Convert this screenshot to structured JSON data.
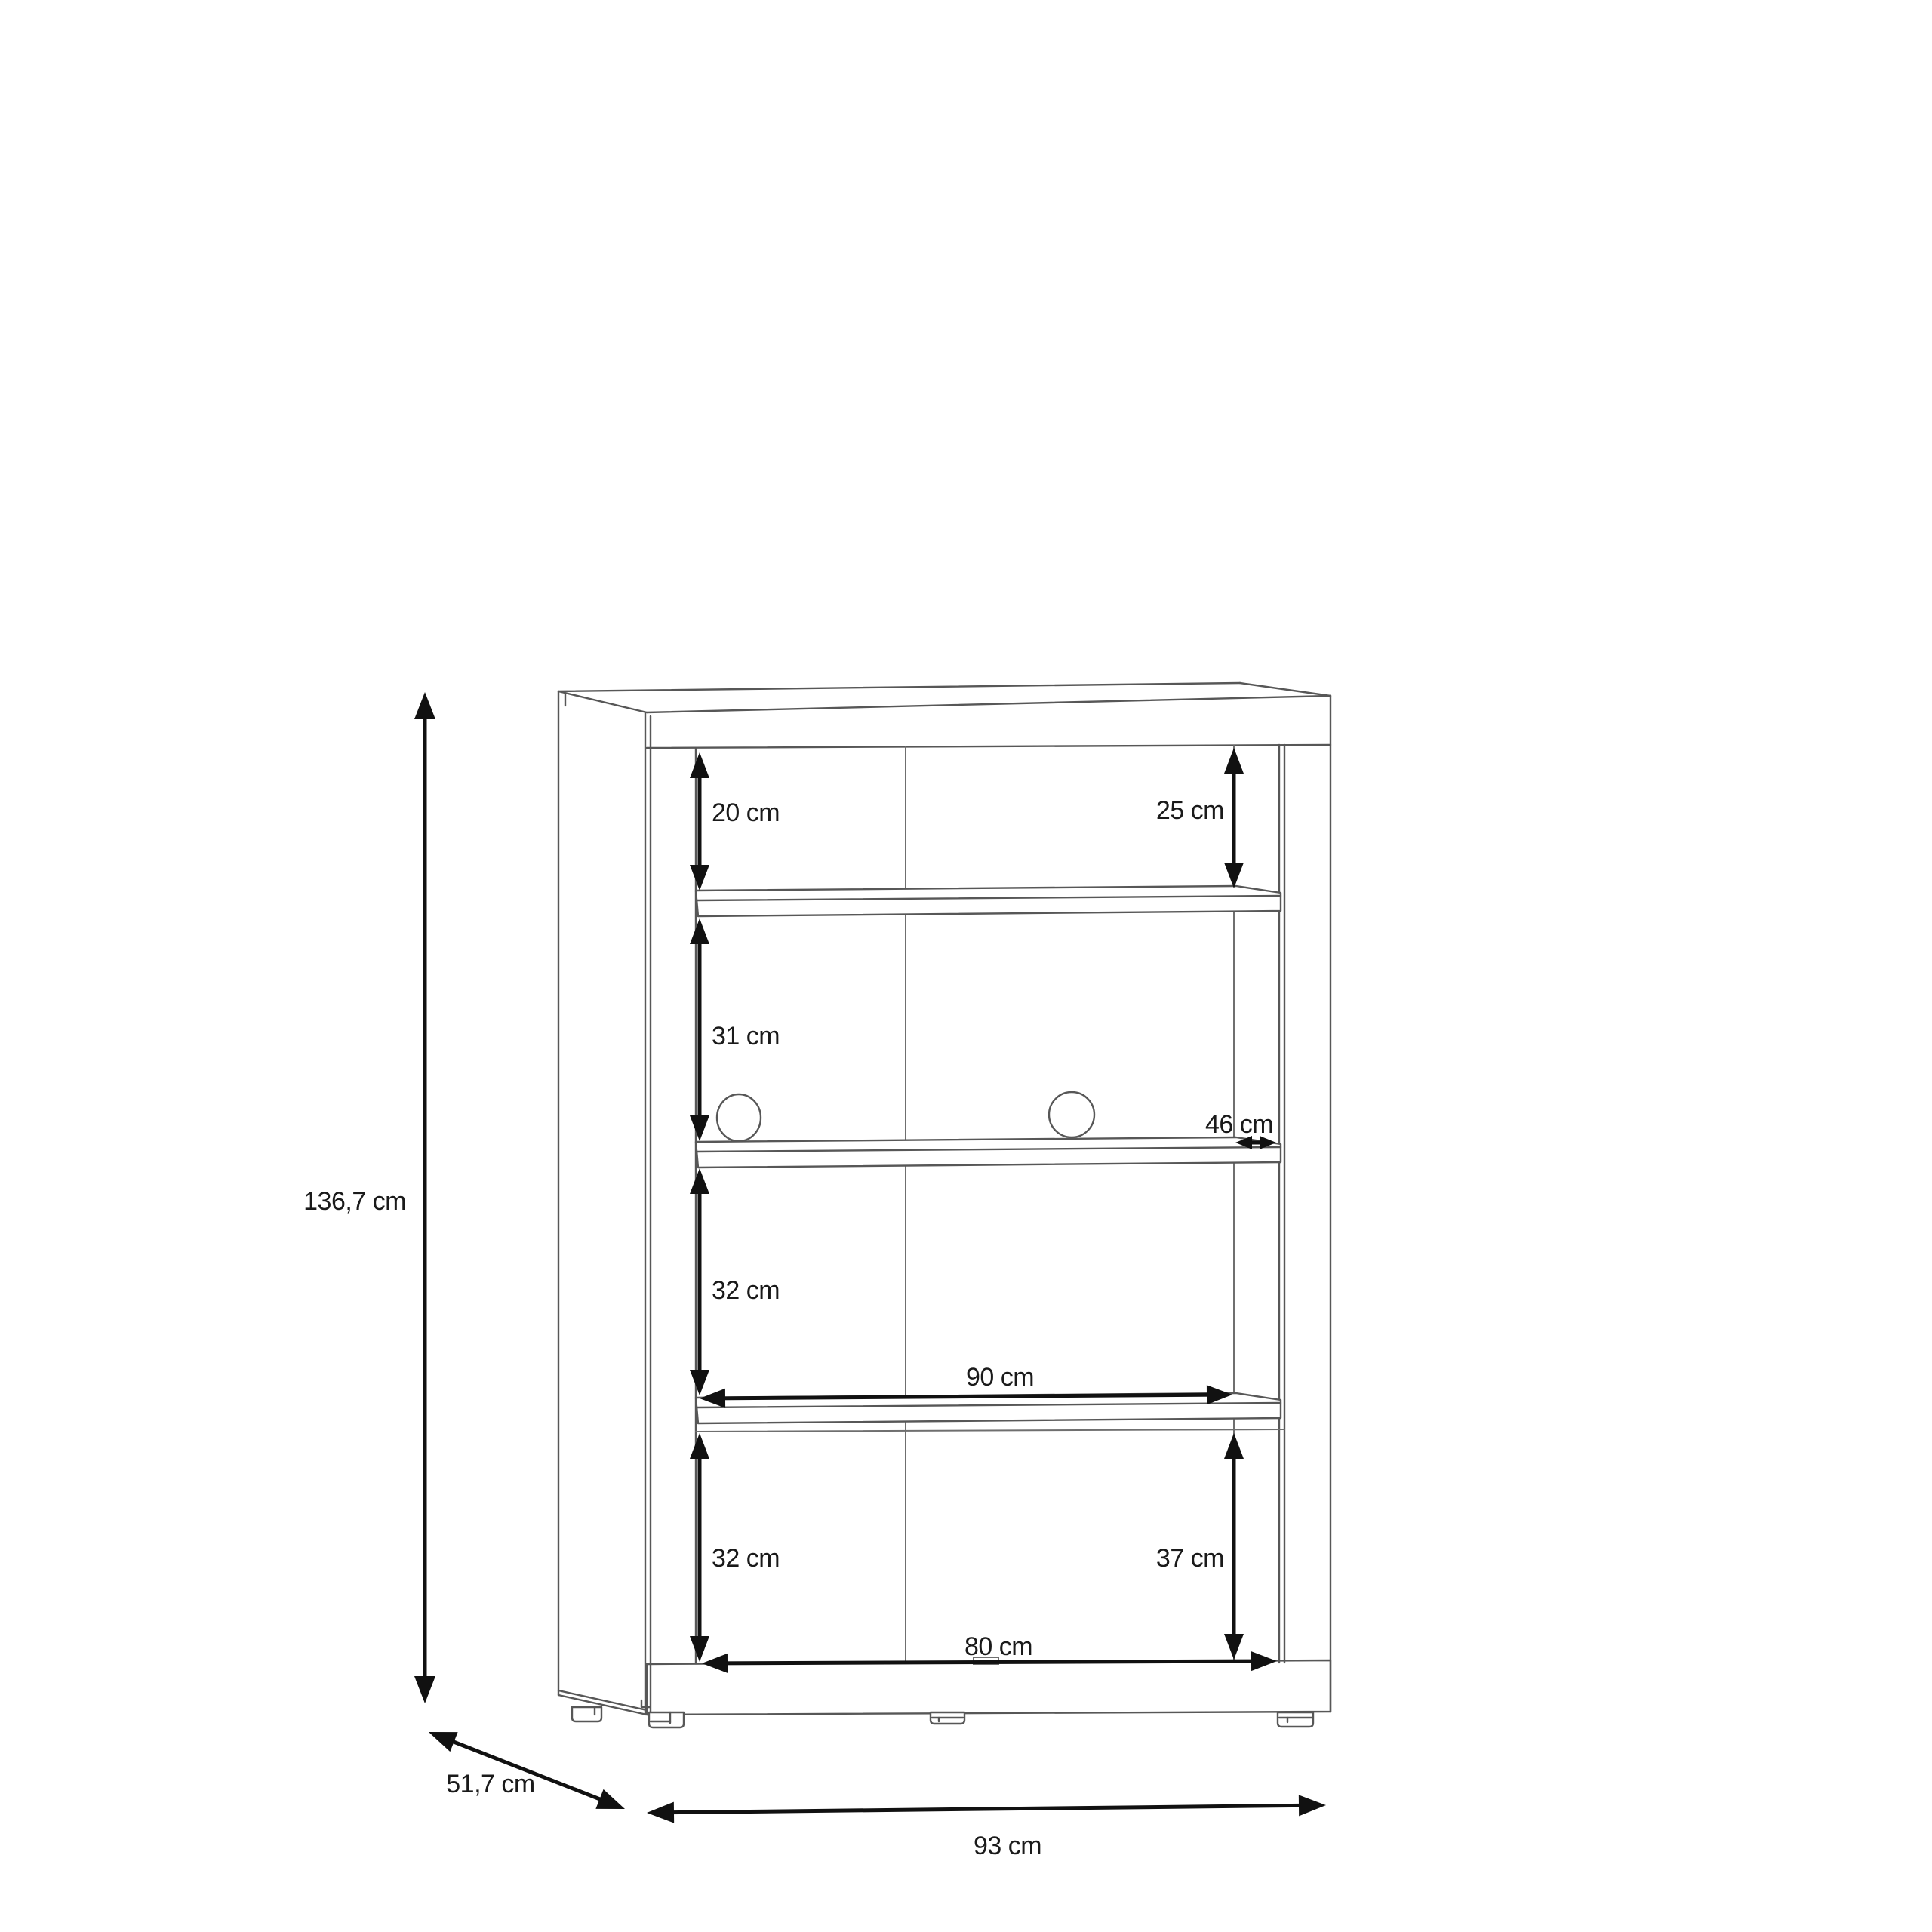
{
  "diagram": {
    "type": "furniture-dimension-drawing",
    "subject": "cabinet-with-shelves-front-perspective",
    "unit": "cm",
    "colors": {
      "outline": "#575757",
      "light_line": "#6f6f6f",
      "dimension": "#111111",
      "text": "#1a1a1a",
      "background": "#ffffff"
    },
    "overall_dimensions": {
      "height": "136,7 cm",
      "depth": "51,7 cm",
      "width": "93 cm"
    },
    "interior_dimensions": {
      "top_left_gap": "20 cm",
      "top_right_gap": "25 cm",
      "second_gap": "31 cm",
      "interior_depth": "46 cm",
      "third_gap": "32 cm",
      "shelf_width": "90 cm",
      "bottom_left_gap": "32 cm",
      "bottom_right_gap": "37 cm",
      "bottom_width": "80 cm"
    },
    "features": {
      "shelves": 3,
      "cable_holes": 2,
      "feet": 4
    }
  }
}
